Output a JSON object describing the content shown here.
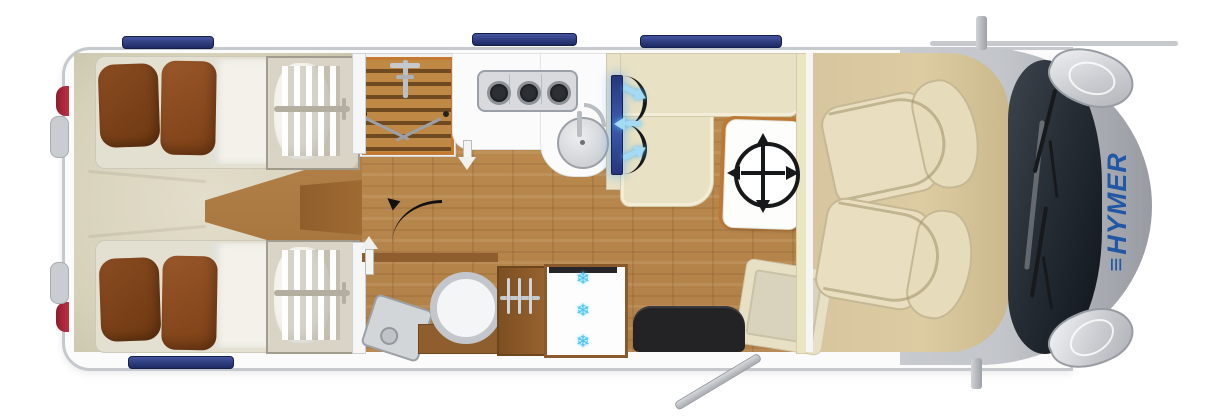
{
  "brand": {
    "logo_mark": "≡",
    "logo_text": "HYMER",
    "logo_color": "#2257a6"
  },
  "refrigerator": {
    "snowflakes": [
      "❄",
      "❄",
      "❄"
    ]
  },
  "colors": {
    "brand_blue": "#2257a6",
    "window_navy": "#2c3a85",
    "wood_floor": "#b5834a",
    "bedroom_cream": "#d9d4bd",
    "bench_cream": "#e9e1c4",
    "pillow_brown": "#8a4a1e",
    "tv_blue": "#2b3f8c",
    "tv_glow_cyan": "#a5daf5",
    "snowflake_cyan": "#47c2f2",
    "taillight_red": "#b5243a",
    "cab_gray": "#b4b7bc",
    "cab_interior_beige": "#d6c59e",
    "shower_wood": "#c08845",
    "wardrobe_wood": "#8a5a2c"
  }
}
